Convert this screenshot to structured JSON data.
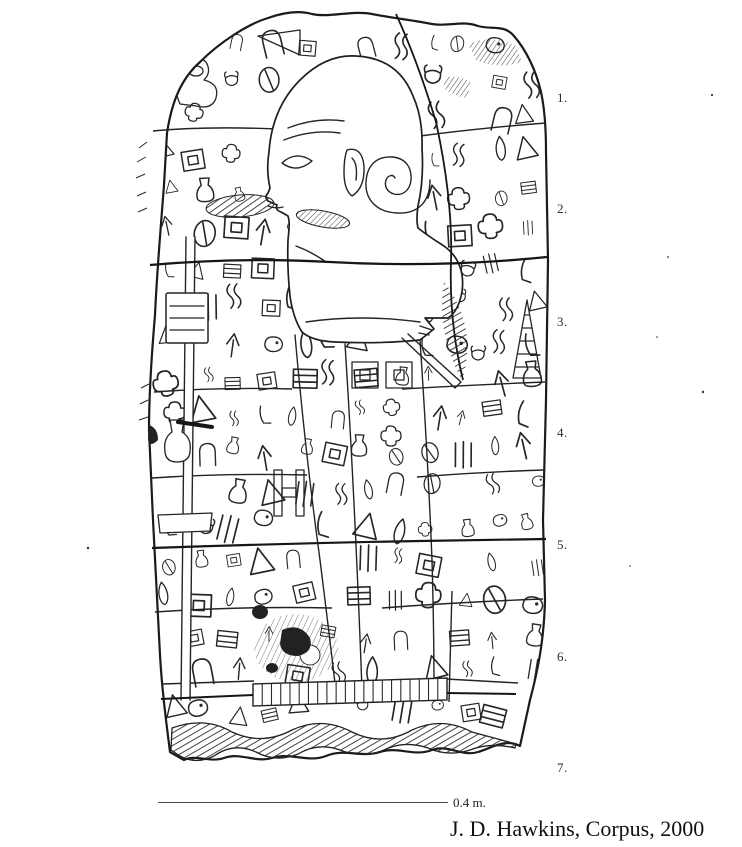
{
  "colors": {
    "paper": "#ffffff",
    "ink": "#1f1f1f"
  },
  "registers": [
    {
      "label": "1."
    },
    {
      "label": "2."
    },
    {
      "label": "3."
    },
    {
      "label": "4."
    },
    {
      "label": "5."
    },
    {
      "label": "6."
    },
    {
      "label": "7."
    }
  ],
  "scale_bar": {
    "label": "0.4 m."
  },
  "caption": {
    "text": "J. D. Hawkins, Corpus, 2000"
  }
}
